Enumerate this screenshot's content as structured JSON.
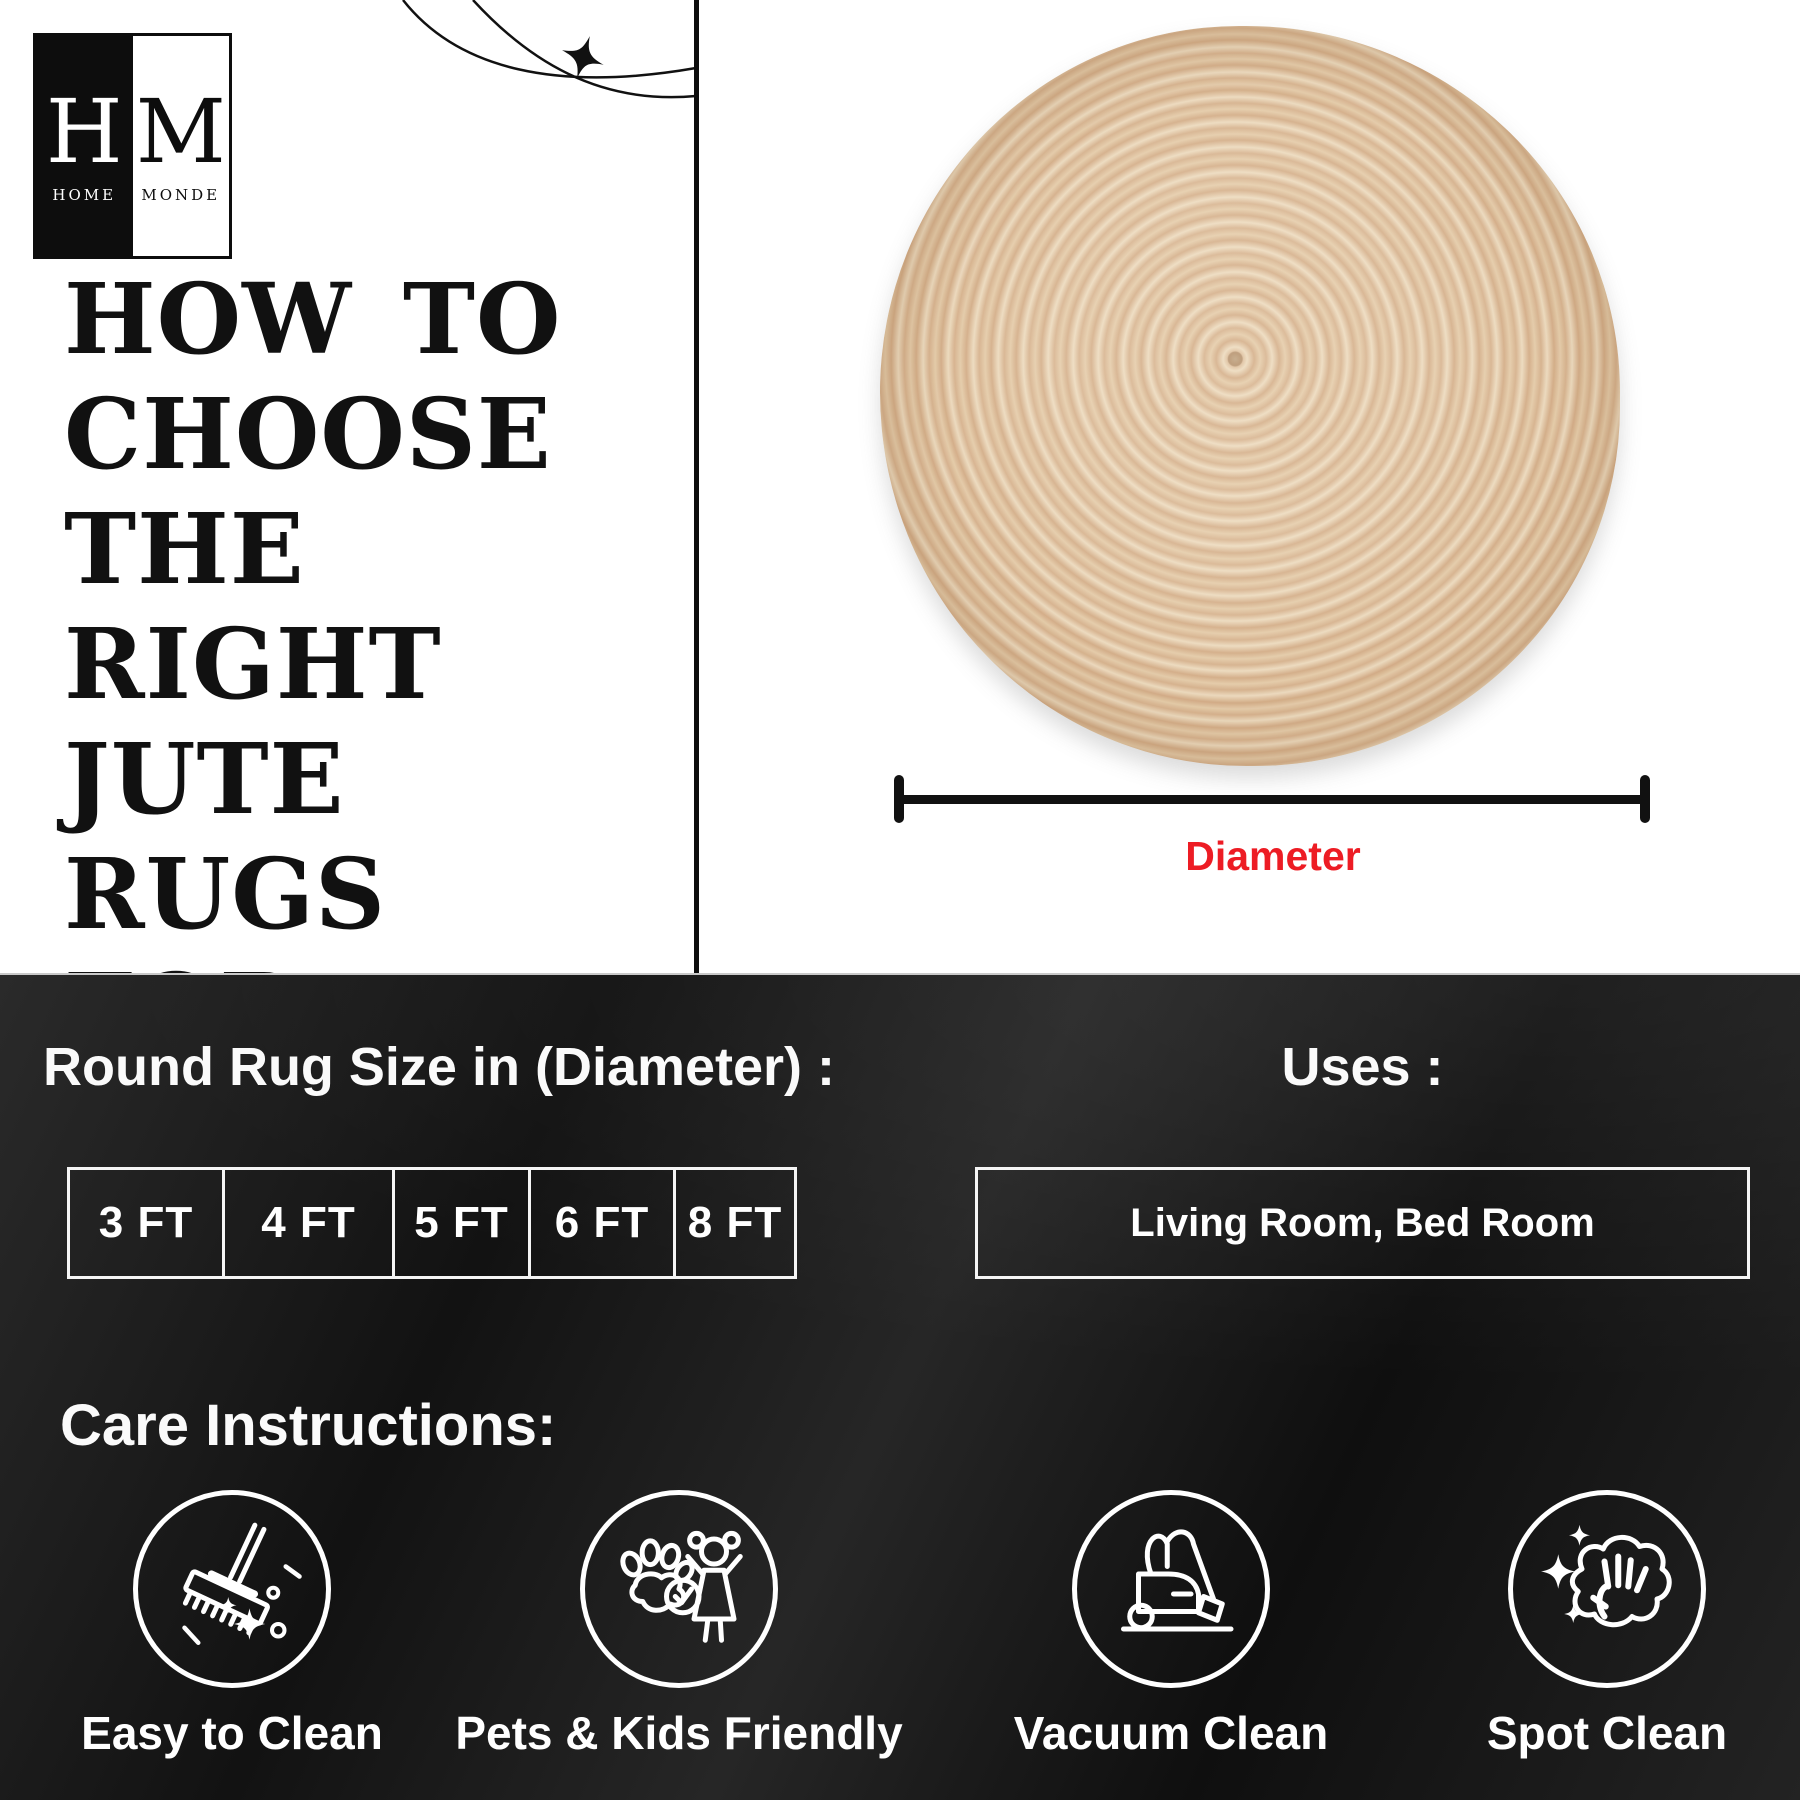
{
  "brand": {
    "monogram_left": "H",
    "monogram_right": "M",
    "word_left": "HOME",
    "word_right": "MONDE"
  },
  "hero": {
    "title_lines": [
      "HOW TO",
      "CHOOSE",
      "THE RIGHT",
      "JUTE RUGS",
      "FOR YOUR",
      "SPACE"
    ]
  },
  "diagram": {
    "dimension_label": "Diameter"
  },
  "sizes": {
    "heading": "Round Rug Size in (Diameter) :",
    "options": [
      "3 FT",
      "4 FT",
      "5 FT",
      "6 FT",
      "8 FT"
    ]
  },
  "uses": {
    "heading": "Uses :",
    "value": "Living Room, Bed Room"
  },
  "care": {
    "heading": "Care Instructions:",
    "items": [
      {
        "icon": "mop-icon",
        "label": "Easy to Clean"
      },
      {
        "icon": "pets-kids-icon",
        "label": "Pets & Kids Friendly"
      },
      {
        "icon": "vacuum-icon",
        "label": "Vacuum Clean"
      },
      {
        "icon": "spot-clean-icon",
        "label": "Spot Clean"
      }
    ]
  },
  "colors": {
    "accent_red": "#ed1c24",
    "panel_dark": "#161616",
    "rug_tan": "#ddbd9c"
  }
}
